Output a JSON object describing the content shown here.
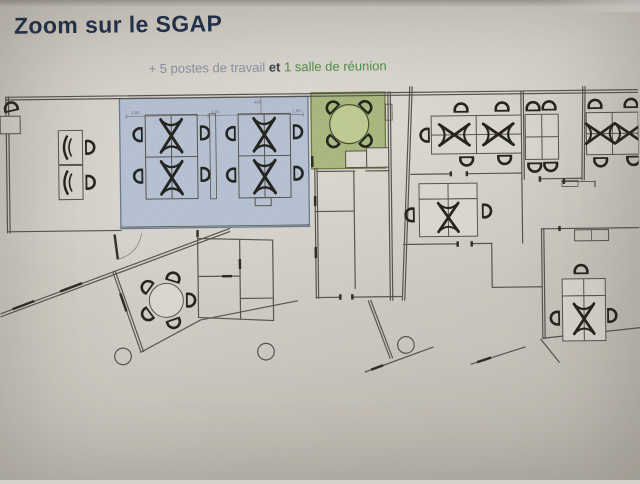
{
  "slide": {
    "title": "Zoom sur le SGAP",
    "subtitle": {
      "part1": "+ 5 postes de travail",
      "connector": " et ",
      "part2": "1 salle de réunion"
    }
  },
  "floor_plan": {
    "dimensions": {
      "d1": "1,00",
      "d2": "1,04",
      "d3": "1,00",
      "d4": "400"
    }
  },
  "colors": {
    "paper": "#d6d2c9",
    "title_text": "#20304e",
    "subtitle_muted": "#8893a5",
    "subtitle_strong": "#39404c",
    "subtitle_green": "#4f9148",
    "line": "#57544f",
    "furniture": "#23231f",
    "dim_text": "#6a7386",
    "zone_work_fill": "#b5c1d1",
    "zone_work_stroke": "#6a7a92",
    "zone_meet_fill": "#a9b87e",
    "zone_meet_stroke": "#6d7a42",
    "zone_meet_table": "#bfca93",
    "desk_fill": "#d9d6cd"
  }
}
